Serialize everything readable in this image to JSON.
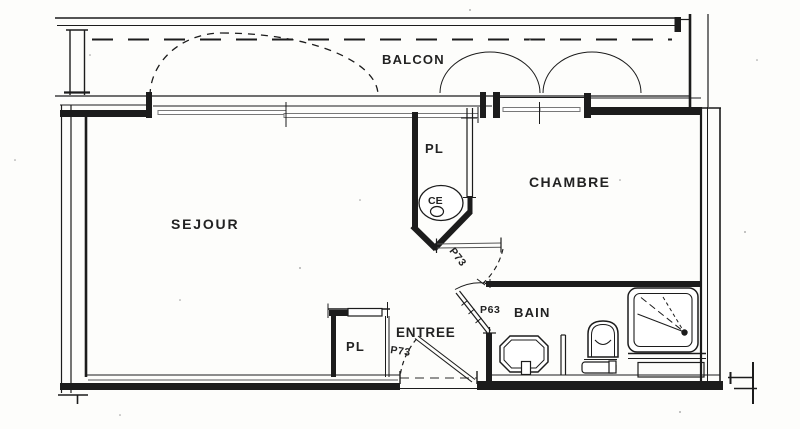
{
  "colors": {
    "paper": "#fdfdfb",
    "ink": "#1c1c1c",
    "grey": "#8f8f8f",
    "midgrey": "#555555"
  },
  "plan": {
    "rooms": {
      "balcon": "BALCON",
      "sejour": "SEJOUR",
      "chambre": "CHAMBRE",
      "placard_haut": "PL",
      "entree": "ENTREE",
      "bain": "BAIN",
      "placard_entree": "PL"
    },
    "equipment": {
      "chauffe_eau": "CE"
    },
    "doors": {
      "porte_chambre": "P73",
      "porte_bain": "P63",
      "porte_entree": "P73"
    }
  }
}
